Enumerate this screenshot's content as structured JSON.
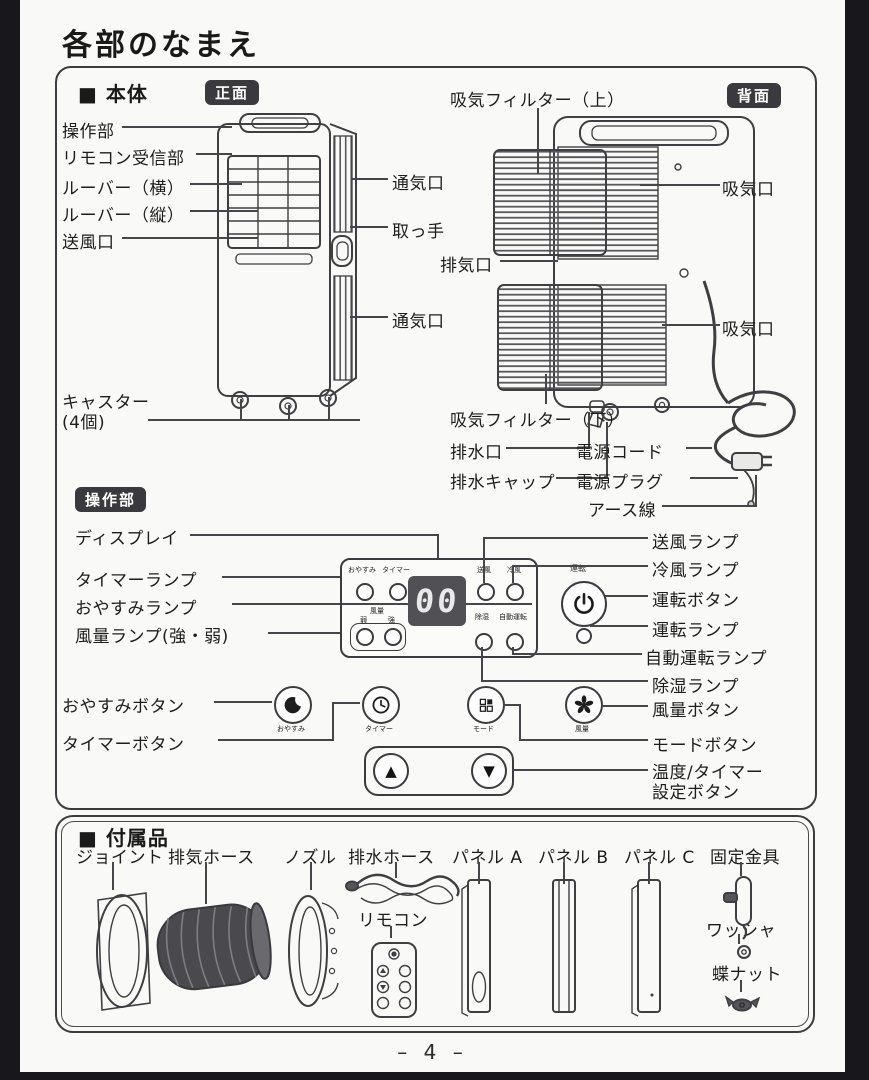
{
  "page": {
    "title": "各部のなまえ",
    "page_number": "– 4 –"
  },
  "main_unit": {
    "heading": "■ 本体",
    "front_badge": "正面",
    "back_badge": "背面",
    "left_labels": [
      "操作部",
      "リモコン受信部",
      "ルーバー（横）",
      "ルーバー（縦）",
      "送風口"
    ],
    "caster_line1": "キャスター",
    "caster_line2": "(4個)",
    "vent_top": "通気口",
    "handle": "取っ手",
    "exhaust": "排気口",
    "vent_bottom": "通気口",
    "filter_top": "吸気フィルター（上）",
    "intake_top": "吸気口",
    "intake_bottom": "吸気口",
    "filter_bottom": "吸気フィルター（下）",
    "drain": "排水口",
    "drain_cap": "排水キャップ",
    "power_cord": "電源コード",
    "power_plug": "電源プラグ",
    "earth_wire": "アース線"
  },
  "control": {
    "badge": "操作部",
    "left_labels": [
      "ディスプレイ",
      "タイマーランプ",
      "おやすみランプ",
      "風量ランプ(強・弱)"
    ],
    "right_labels": [
      "送風ランプ",
      "冷風ランプ",
      "運転ボタン",
      "運転ランプ",
      "自動運転ランプ",
      "除湿ランプ"
    ],
    "sleep_button_label": "おやすみボタン",
    "timer_button_label": "タイマーボタン",
    "fan_button_label": "風量ボタン",
    "mode_button_label": "モードボタン",
    "temp_set_line1": "温度/タイマー",
    "temp_set_line2": "設定ボタン",
    "panel": {
      "sleep": "おやすみ",
      "timer": "タイマー",
      "display_value": "00",
      "fan_blow": "送風",
      "cool": "冷風",
      "fan_level": "風量",
      "weak": "弱",
      "strong": "強",
      "dehumidify": "除湿",
      "auto": "自動運転",
      "power": "運転"
    },
    "buttons": {
      "sleep": "おやすみ",
      "timer": "タイマー",
      "mode": "モード",
      "fan": "風量",
      "up": "▲",
      "down": "▼"
    }
  },
  "accessories": {
    "heading": "■ 付属品",
    "labels": [
      "ジョイント",
      "排気ホース",
      "ノズル",
      "排水ホース",
      "パネル A",
      "パネル B",
      "パネル C",
      "固定金具"
    ],
    "remote": "リモコン",
    "washer": "ワッシャ",
    "wing_nut": "蝶ナット"
  }
}
